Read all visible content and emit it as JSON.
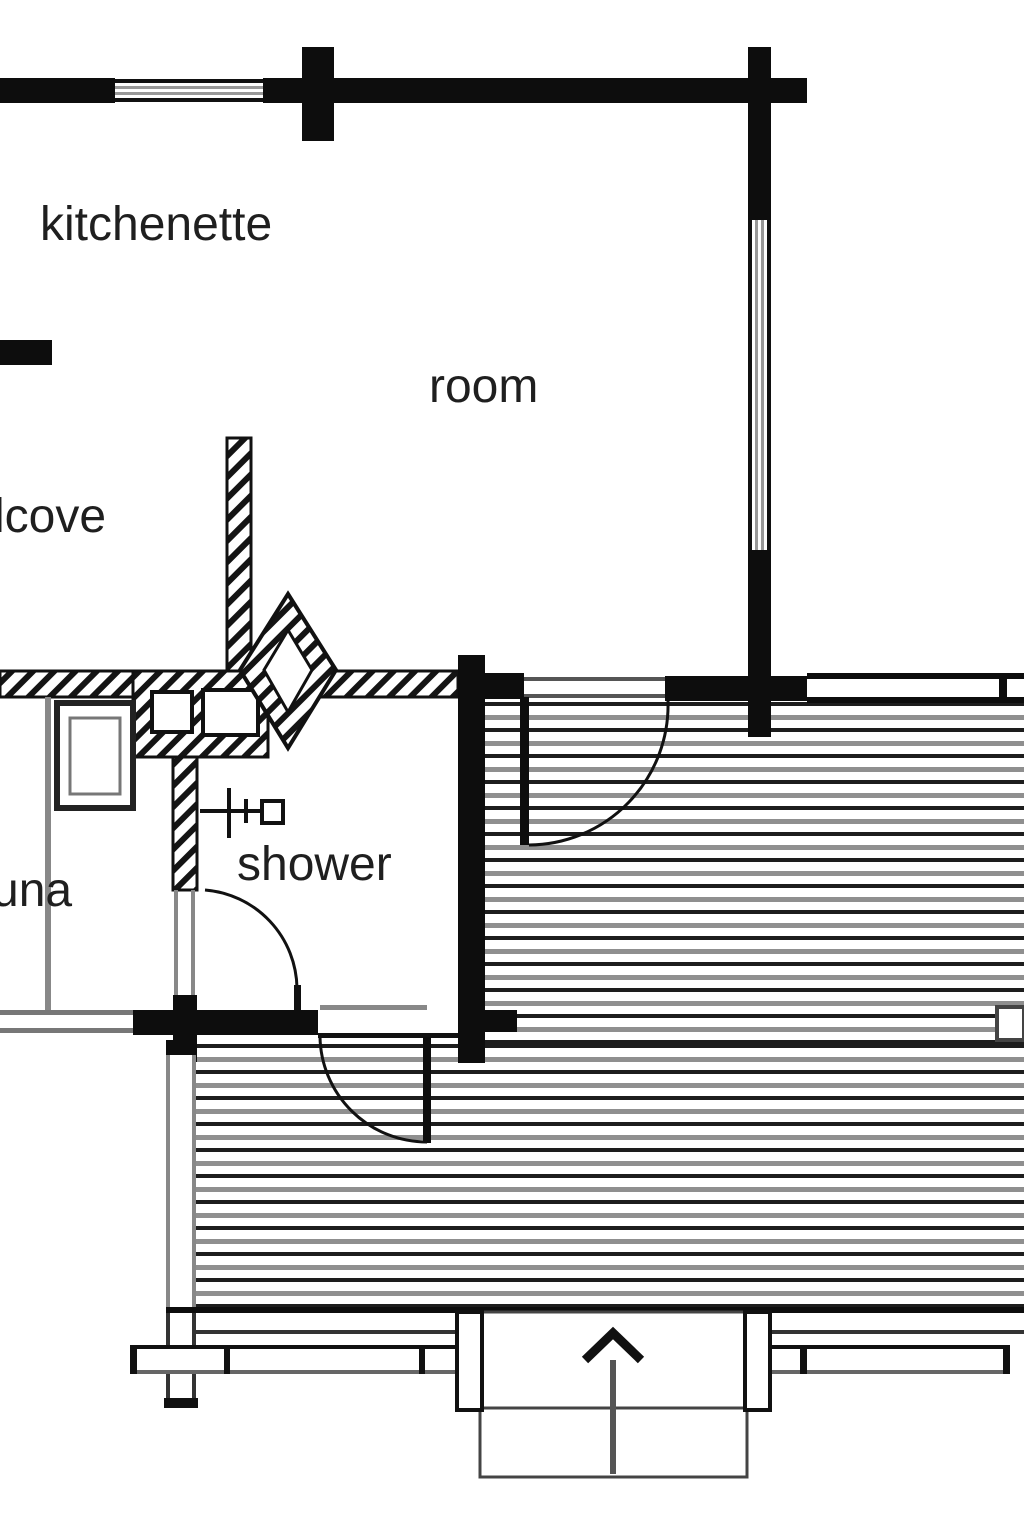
{
  "document": {
    "type": "floor-plan",
    "description": "log cabin floor plan with deck"
  },
  "labels": {
    "kitchenette": "kitchenette",
    "room": "room",
    "alcove_partial": "lcove",
    "sauna_partial": "una",
    "shower": "shower"
  },
  "colors": {
    "background": "#ffffff",
    "wall_black": "#0d0d0d",
    "hatch_black": "#141414",
    "thin_gray": "#888888",
    "deck_board_dark": "#1d1d1d",
    "deck_board_gray": "#8f8f8f"
  },
  "symbols": [
    "window",
    "door-swing-arc",
    "shower-mixer",
    "sauna-stove",
    "corner-fireplace",
    "deck-boards",
    "railing",
    "entrance-steps",
    "entrance-arrow"
  ]
}
